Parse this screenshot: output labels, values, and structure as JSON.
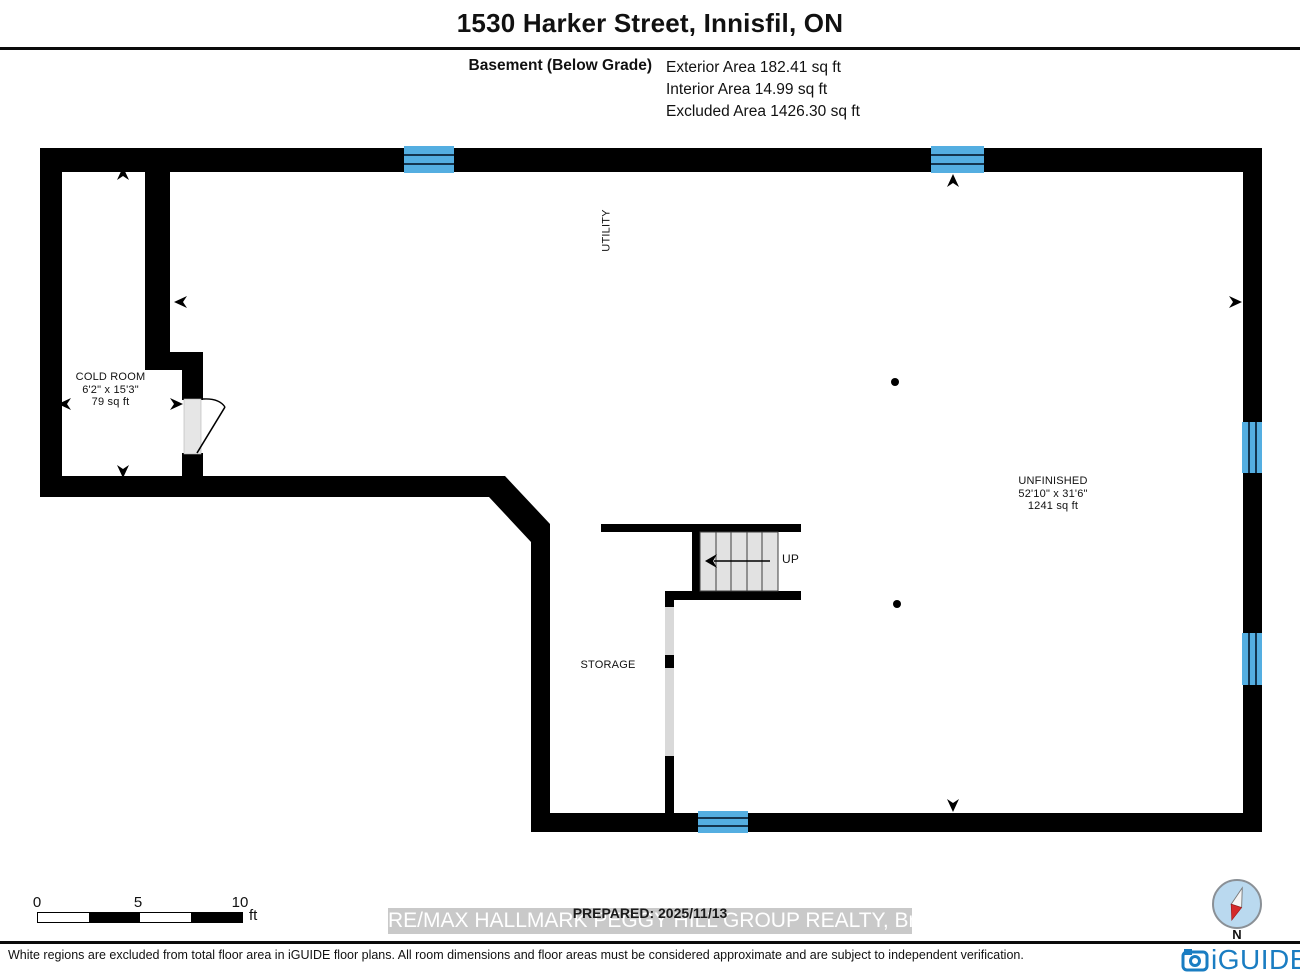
{
  "header": {
    "title": "1530 Harker Street, Innisfil, ON"
  },
  "area_summary": {
    "floor_label": "Basement (Below Grade)",
    "stats": [
      "Exterior Area 182.41 sq ft",
      "Interior Area 14.99 sq ft",
      "Excluded Area 1426.30 sq ft"
    ]
  },
  "rooms": {
    "cold_room": {
      "name": "COLD ROOM",
      "dimensions": "6'2\" x 15'3\"",
      "area": "79 sq ft"
    },
    "utility": {
      "name": "UTILITY"
    },
    "unfinished": {
      "name": "UNFINISHED",
      "dimensions": "52'10\" x 31'6\"",
      "area": "1241 sq ft"
    },
    "storage": {
      "name": "STORAGE"
    },
    "stairs": {
      "label": "UP"
    }
  },
  "scale_bar": {
    "ticks": [
      "0",
      "5",
      "10"
    ],
    "unit": "ft"
  },
  "prepared": {
    "label": "PREPARED: 2025/11/13"
  },
  "watermark": {
    "text": "RE/MAX HALLMARK PEGGY HILL GROUP REALTY, Brokerage"
  },
  "compass": {
    "label": "N"
  },
  "branding": {
    "logo_text": "iGUIDE"
  },
  "footer": {
    "disclaimer": "White regions are excluded from total floor area in iGUIDE floor plans. All room dimensions and floor areas must be considered approximate and are subject to independent verification."
  },
  "colors": {
    "wall": "#000000",
    "window": "#54aee1",
    "window_line": "#14354f",
    "stair_fill": "#e2e2e2",
    "door_fill": "#e6e6e6",
    "partial_wall": "#d9d9d9",
    "iguide_blue": "#1a7dc2",
    "compass_fill": "#bad9ef",
    "compass_red": "#d42a2a",
    "watermark_bg": "#c9c9c9"
  }
}
